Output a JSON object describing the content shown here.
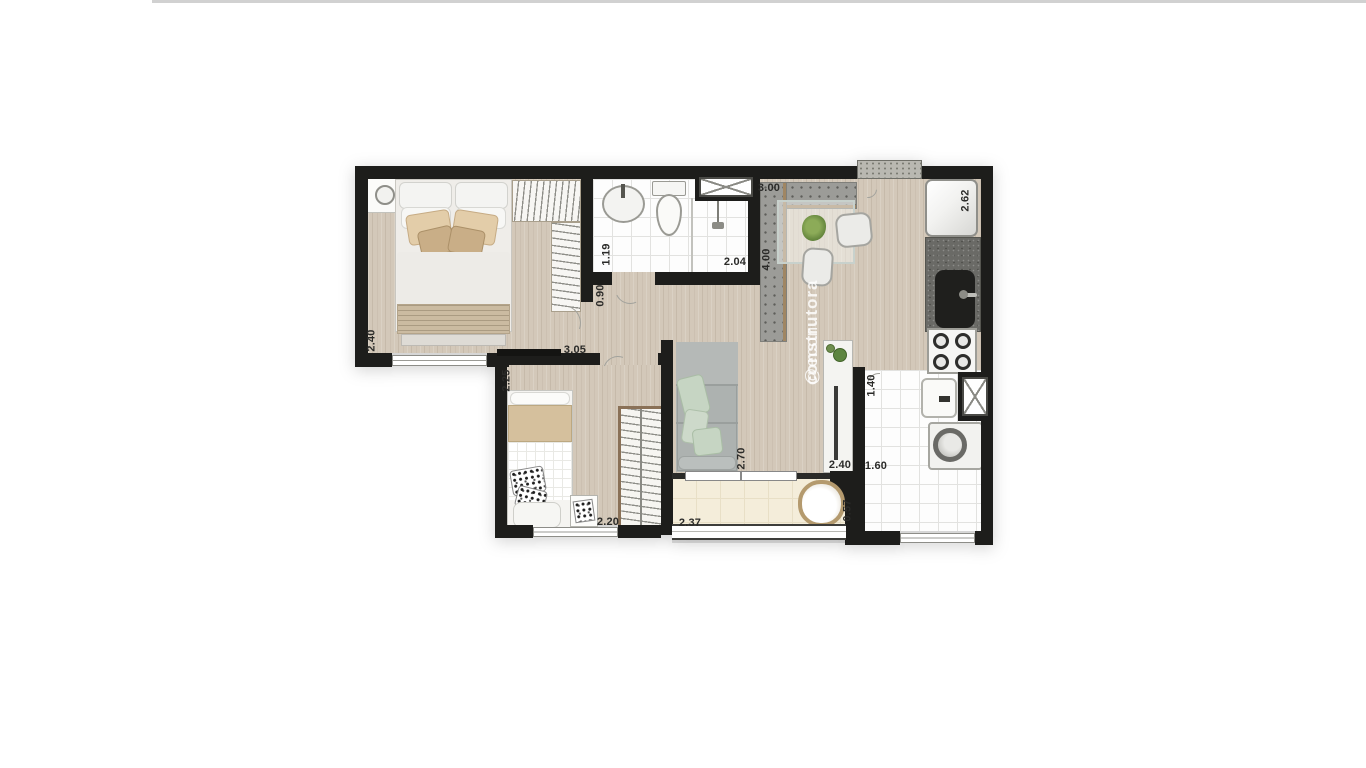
{
  "image": {
    "type": "apartment-floor-plan",
    "background": "#ffffff"
  },
  "watermark": {
    "handle_prefix": "@econ",
    "handle_suffix": "construtora",
    "full": "@econconstrutora"
  },
  "colors": {
    "wall": "#1d1d1b",
    "wood_floor": "#d3c8b9",
    "tile_floor": "#fdfdfd",
    "balcony_floor": "#f4edda",
    "counter_concrete": "#9c9c98",
    "counter_dark": "#6a6a66",
    "sofa_gray": "#adb2b0",
    "cushion_green": "#c6d5c3",
    "bedding_beige": "#d8c3a1",
    "wood_trim": "#8a7157"
  },
  "rooms": {
    "master_bedroom": {
      "name": "master bedroom",
      "dim_width": "2.40",
      "dim_length": "3.05"
    },
    "bathroom": {
      "name": "bathroom",
      "dim_width": "1.19",
      "dim_length": "2.04"
    },
    "hall": {
      "name": "hall",
      "dim_width": "0.90"
    },
    "kitchen_dining": {
      "name": "kitchen / dining",
      "dim_counter": "3.00",
      "dim_length": "4.00",
      "dim_right": "2.62"
    },
    "bedroom_2": {
      "name": "bedroom 2",
      "dim_width": "2.25",
      "dim_length": "2.20"
    },
    "living_room": {
      "name": "living room",
      "dim_depth": "2.70",
      "dim_width": "2.40"
    },
    "laundry": {
      "name": "laundry",
      "dim_width": "1.40",
      "dim_length": "1.60"
    },
    "balcony": {
      "name": "balcony",
      "dim_length": "2.37",
      "dim_depth": "0.57"
    }
  },
  "fixtures": [
    "double-bed",
    "nightstand",
    "wardrobe",
    "washbasin",
    "toilet",
    "shower",
    "dining-table",
    "dining-chair",
    "plant",
    "refrigerator",
    "kitchen-sink",
    "cooktop",
    "water-heater",
    "washing-machine",
    "sofa",
    "tv-rack",
    "single-bed",
    "rug",
    "round-chair"
  ]
}
